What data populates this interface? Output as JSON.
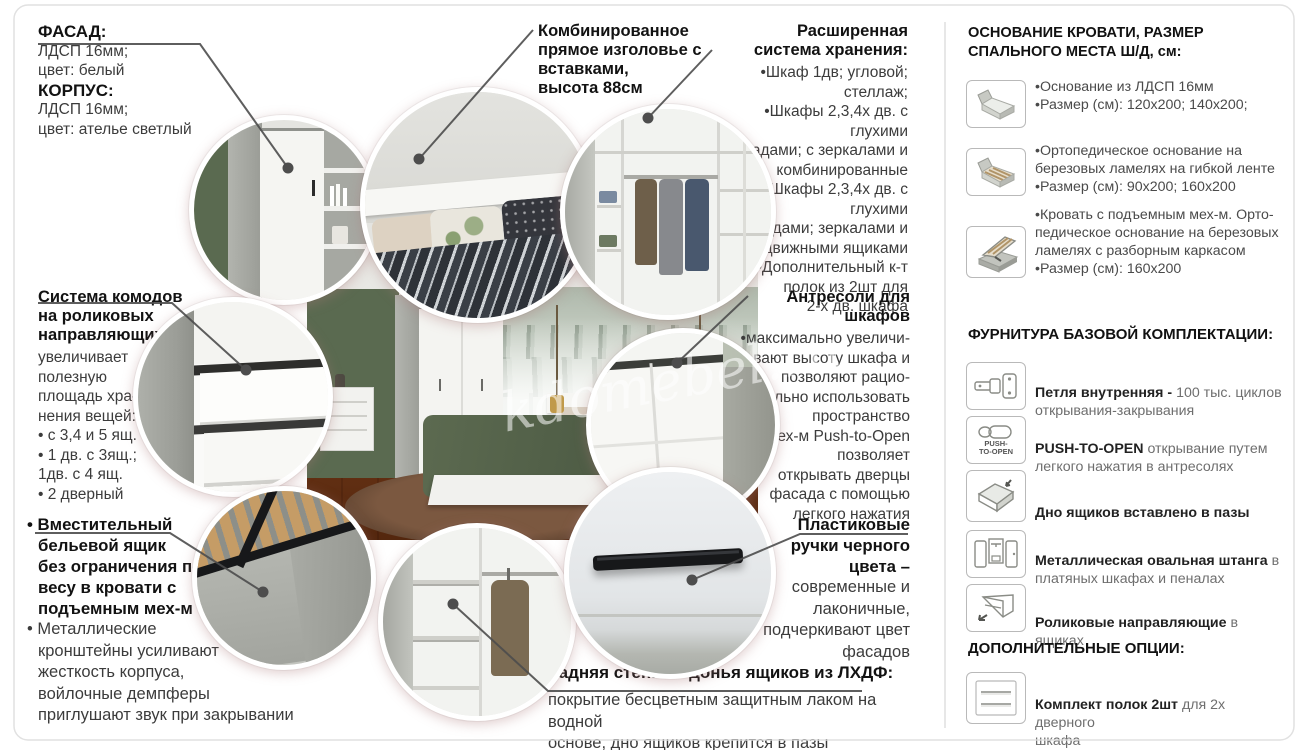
{
  "page": {
    "watermark": "kdomebel.ru"
  },
  "callouts": {
    "facade": {
      "heading1": "ФАСАД:",
      "body1": "ЛДСП 16мм;\nцвет: белый",
      "heading2": "КОРПУС:",
      "body2": "ЛДСП 16мм;\nцвет: ателье светлый"
    },
    "headboard": {
      "heading": "Комбинированное\nпрямое изголовье с\nвставками,\nвысота 88см"
    },
    "storage": {
      "heading": "Расширенная\nсистема хранения:",
      "body": "•Шкаф 1дв; угловой; стеллаж;\n•Шкафы 2,3,4х дв. с глухими\nфасадами; с зеркалами и\nкомбинированные\n•Шкафы 2,3,4х дв. с глухими\nфасадами; зеркалами и\nвыдвижными ящиками\n•Дополнительный к-т\nполок из 2шт для\n2-х дв. шкафа"
    },
    "dressers": {
      "heading": "Система комодов\nна роликовых\nнаправляющих",
      "body": "увеличивает\nполезную\nплощадь хра-\nнения вещей:\n• с 3,4 и 5 ящ.\n• 1 дв. с 3ящ.;\n1дв. с 4 ящ.\n• 2 дверный"
    },
    "antresoli": {
      "heading": "Антресоли для\nшкафов",
      "body": "•максимально увеличи-\nвают высоту шкафа и\nпозволяют рацио-\nнально использовать\nпространство\n•мех-м Push-to-Open\nпозволяет\nоткрывать дверцы\nфасада с помощью\nлегкого нажатия"
    },
    "linen_box": {
      "heading": "• Вместительный\nбельевой ящик\nбез ограничения по\nвесу в кровати с\nподъемным мех-м",
      "body": "• Металлические\nкронштейны усиливают\nжесткость корпуса,\nвойлочные демпферы\nприглушают звук при закрывании"
    },
    "handles": {
      "heading": "Пластиковые\nручки черного\nцвета –",
      "body": "современные и\nлаконичные,\nподчеркивают цвет\nфасадов"
    },
    "back_panel": {
      "heading": "Задняя стенка и донья ящиков из ЛХДФ:",
      "body": "покрытие бесцветным защитным лаком на водной\nоснове, дно ящиков крепится в пазы"
    }
  },
  "panel": {
    "bed_heading": "ОСНОВАНИЕ КРОВАТИ, РАЗМЕР\nСПАЛЬНОГО МЕСТА Ш/Д, см:",
    "beds": [
      {
        "text": "•Основание из ЛДСП 16мм\n•Размер (см): 120х200; 140х200;"
      },
      {
        "text": "•Ортопедическое основание на\nберезовых ламелях на гибкой ленте\n•Размер (см): 90х200; 160х200"
      },
      {
        "text": "•Кровать с подъемным мех-м. Орто-\nпедическое основание на березовых\nламелях с разборным каркасом\n•Размер (см): 160х200"
      }
    ],
    "fittings_heading": "ФУРНИТУРА БАЗОВОЙ КОМПЛЕКТАЦИИ:",
    "fittings": [
      {
        "bold": "Петля внутренняя - ",
        "rest": "100 тыс. циклов\nоткрывания-закрывания"
      },
      {
        "bold": "PUSH-TO-OPEN ",
        "rest": "открывание путем\nлегкого нажатия в антресолях",
        "icon_label": "PUSH-\nTO-OPEN"
      },
      {
        "bold": "Дно ящиков вставлено в пазы",
        "rest": ""
      },
      {
        "bold": "Металлическая овальная штанга ",
        "rest": "в\nплатяных шкафах и пеналах"
      },
      {
        "bold": "Роликовые направляющие ",
        "rest": "в ящиках"
      }
    ],
    "options_heading": "ДОПОЛНИТЕЛЬНЫЕ ОПЦИИ:",
    "options": [
      {
        "bold": "Комплект полок 2шт ",
        "rest": "для 2х дверного\nшкафа"
      }
    ]
  }
}
